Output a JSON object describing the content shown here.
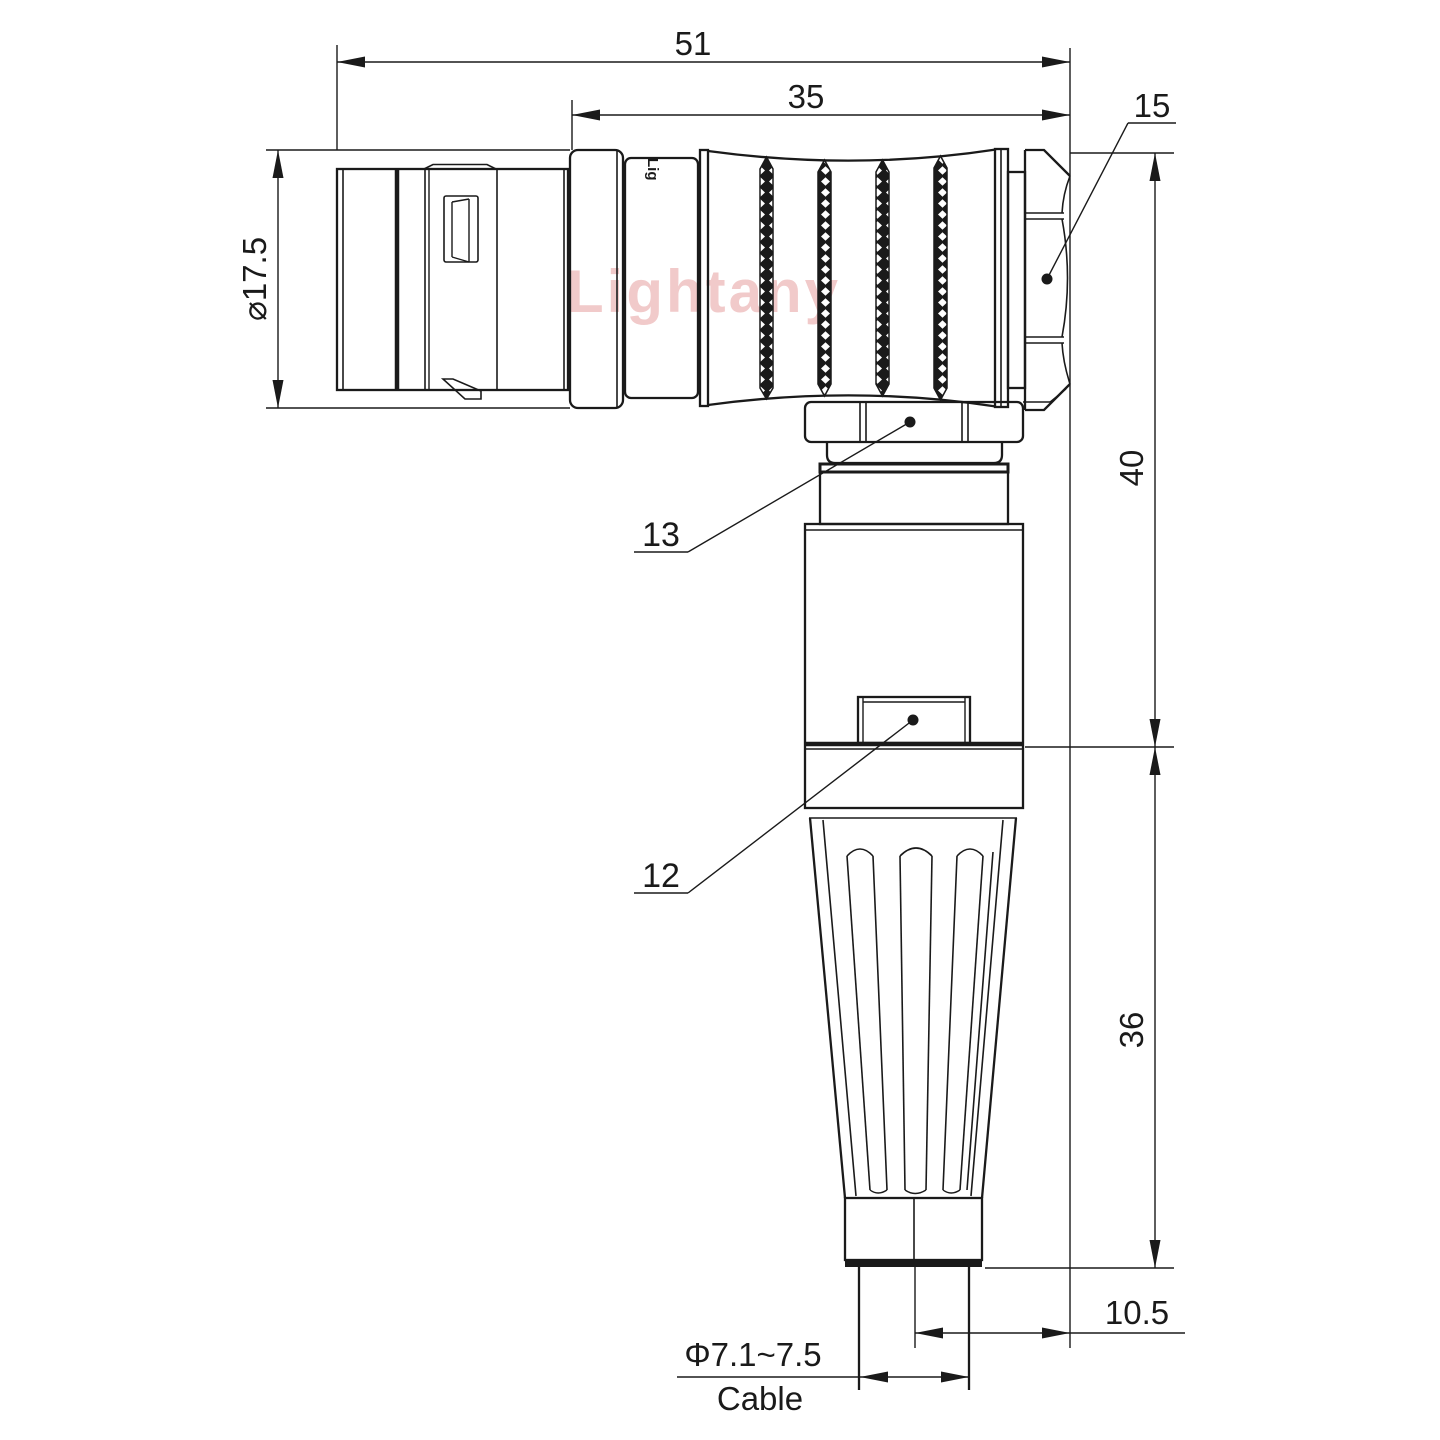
{
  "meta": {
    "type": "technical-drawing",
    "subject": "right-angle circular push-pull connector with cable bend relief, side view with dimensions"
  },
  "watermark": "Lightany",
  "engraving": "Lig",
  "dims": {
    "overall_length": "51",
    "rear_length": "35",
    "hex_callout": "15",
    "shell_diameter": "⌀17.5",
    "upper_height": "40",
    "lower_height": "36",
    "exit_offset": "10.5",
    "cable_range": "Φ7.1~7.5",
    "cable_word": "Cable",
    "part_label_nut": "13",
    "part_label_body": "12"
  },
  "colors": {
    "line": "#1a1a1a",
    "watermark": "#edb9b9",
    "background": "#ffffff"
  }
}
